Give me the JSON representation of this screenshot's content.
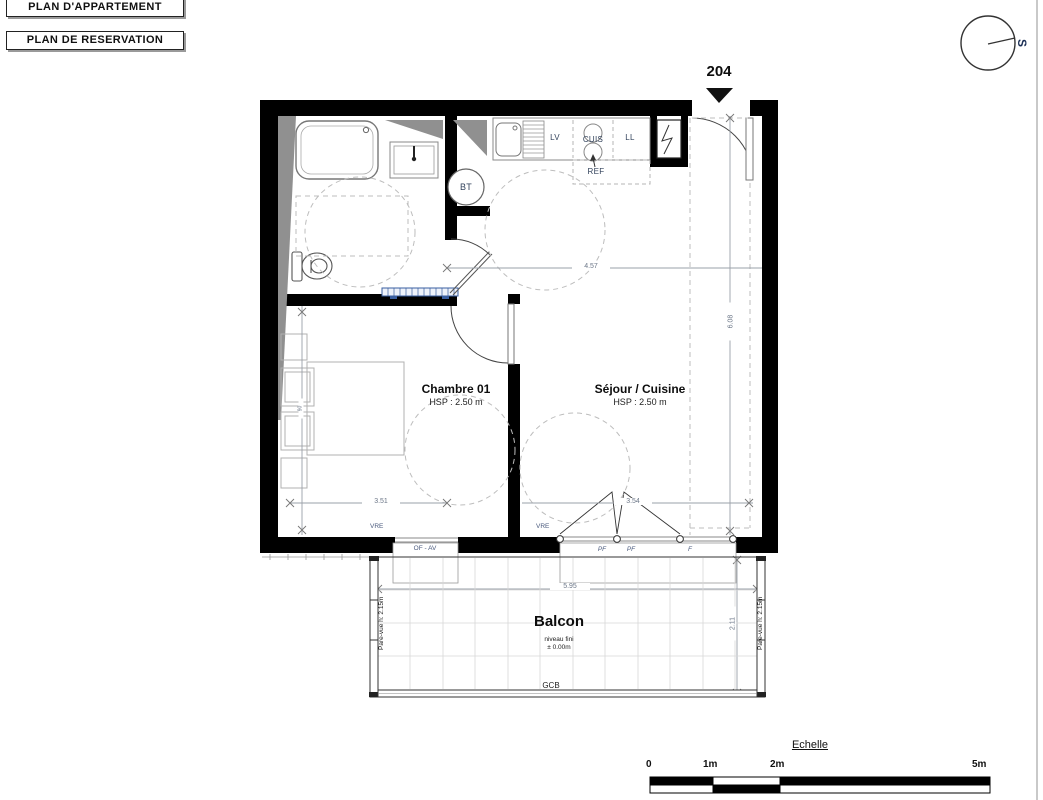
{
  "sheet": {
    "plan_box_1": "PLAN D'APPARTEMENT",
    "plan_box_2": "PLAN DE RESERVATION"
  },
  "compass": {
    "south_label": "S"
  },
  "unit": {
    "number": "204"
  },
  "rooms": {
    "chambre": {
      "name": "Chambre 01",
      "hsp": "HSP : 2.50 m"
    },
    "sejour": {
      "name": "Séjour / Cuisine",
      "hsp": "HSP : 2.50 m"
    },
    "balcon": {
      "name": "Balcon",
      "note1": "niveau fini",
      "note2": "± 0.00m",
      "floor": "GCB",
      "pare_vue": "Pare-vue h: 2.15m"
    }
  },
  "fixtures": {
    "lv": "LV",
    "cuis": "CUIS",
    "ll": "LL",
    "ref": "REF",
    "bt": "BT"
  },
  "openings": {
    "vre": "VRE",
    "of_av": "OF - AV",
    "pf": "PF",
    "f": "F"
  },
  "dims": {
    "entry_width": "4.57",
    "sejour_depth": "6.08",
    "chambre_width": "3.51",
    "sejour_width": "3.54",
    "balcon_width": "5.95",
    "balcon_depth": "2.11",
    "bed_width": "90"
  },
  "scale": {
    "title": "Echelle",
    "t0": "0",
    "t1": "1m",
    "t2": "2m",
    "t5": "5m"
  },
  "colors": {
    "wall": "#000000",
    "duct_gray": "#909090",
    "radiator_blue": "#3a5fa0",
    "label_navy": "#33435c",
    "dim_gray": "#6b7687"
  }
}
